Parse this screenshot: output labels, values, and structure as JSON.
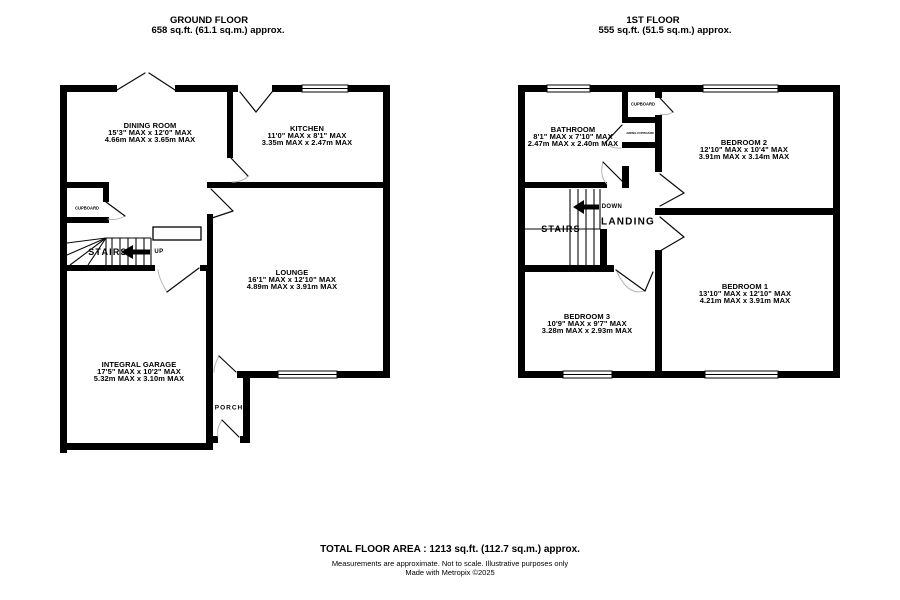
{
  "colors": {
    "wall": "#000000",
    "door_arc": "#b5b5b5",
    "text": "#000000"
  },
  "ground_floor": {
    "title": "GROUND FLOOR",
    "area": "658 sq.ft. (61.1 sq.m.) approx.",
    "rooms": {
      "dining": {
        "name": "DINING ROOM",
        "imperial": "15'3\" MAX x 12'0\" MAX",
        "metric": "4.66m MAX x 3.65m MAX"
      },
      "kitchen": {
        "name": "KITCHEN",
        "imperial": "11'0\" MAX x 8'1\" MAX",
        "metric": "3.35m MAX x 2.47m MAX"
      },
      "lounge": {
        "name": "LOUNGE",
        "imperial": "16'1\" MAX x 12'10\" MAX",
        "metric": "4.89m MAX x 3.91m MAX"
      },
      "garage": {
        "name": "INTEGRAL GARAGE",
        "imperial": "17'5\" MAX x 10'2\" MAX",
        "metric": "5.32m MAX x 3.10m MAX"
      },
      "porch": {
        "name": "PORCH"
      },
      "cupboard": {
        "name": "CUPBOARD"
      },
      "stairs": {
        "name": "STAIRS",
        "direction": "UP"
      }
    }
  },
  "first_floor": {
    "title": "1ST FLOOR",
    "area": "555 sq.ft. (51.5 sq.m.) approx.",
    "rooms": {
      "bathroom": {
        "name": "BATHROOM",
        "imperial": "8'1\" MAX x 7'10\" MAX",
        "metric": "2.47m MAX x 2.40m MAX"
      },
      "bedroom2": {
        "name": "BEDROOM 2",
        "imperial": "12'10\" MAX x 10'4\" MAX",
        "metric": "3.91m MAX x 3.14m MAX"
      },
      "bedroom1": {
        "name": "BEDROOM 1",
        "imperial": "13'10\" MAX x 12'10\" MAX",
        "metric": "4.21m MAX x 3.91m MAX"
      },
      "bedroom3": {
        "name": "BEDROOM 3",
        "imperial": "10'9\" MAX x 9'7\" MAX",
        "metric": "3.28m MAX x 2.93m MAX"
      },
      "landing": {
        "name": "LANDING"
      },
      "stairs": {
        "name": "STAIRS",
        "direction": "DOWN"
      },
      "cupboard": {
        "name": "CUPBOARD"
      },
      "airing_cupboard": {
        "name": "AIRING CUPBOARD"
      }
    }
  },
  "footer": {
    "total": "TOTAL FLOOR AREA : 1213 sq.ft. (112.7 sq.m.) approx.",
    "disclaimer": "Measurements are approximate.  Not to scale.  Illustrative purposes only",
    "credit": "Made with Metropix ©2025"
  }
}
